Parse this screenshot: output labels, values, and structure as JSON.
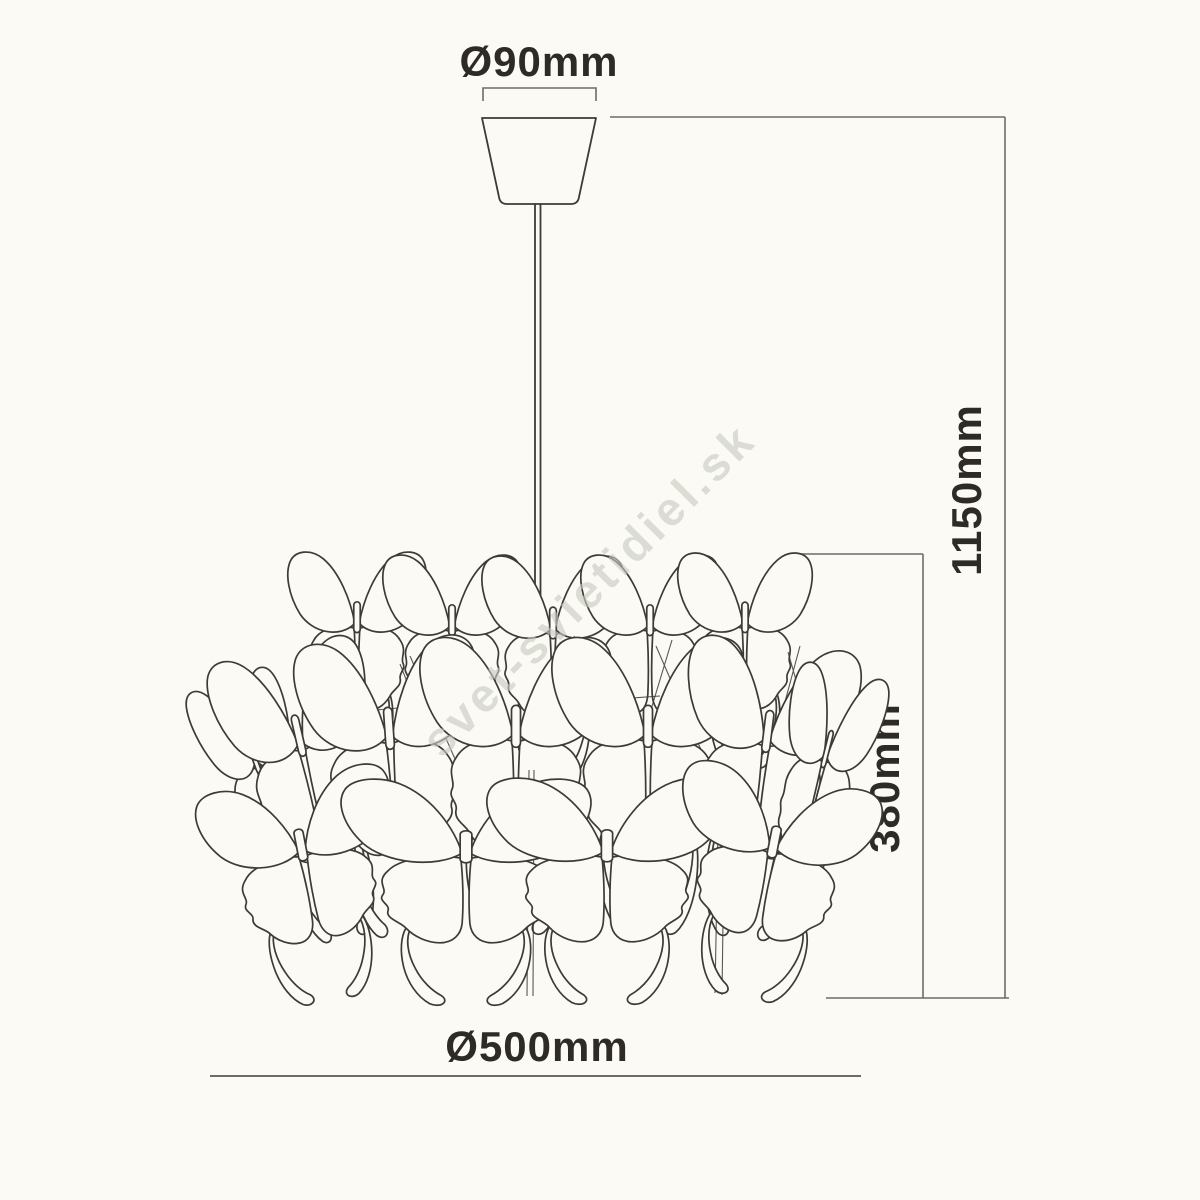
{
  "drawing": {
    "title": "pendant-light-dimension-diagram",
    "watermark": "svet-svietidiel.sk",
    "dimensions": {
      "canopy_diameter": "Ø90mm",
      "overall_height": "1150mm",
      "shade_height": "380mm",
      "shade_diameter": "Ø500mm"
    }
  },
  "colors": {
    "bg": "#fbfaf5",
    "ink": "#3e3a36",
    "dim": "#6f6b66",
    "text": "#2e2b27",
    "watermark": "#c9ccc2"
  }
}
